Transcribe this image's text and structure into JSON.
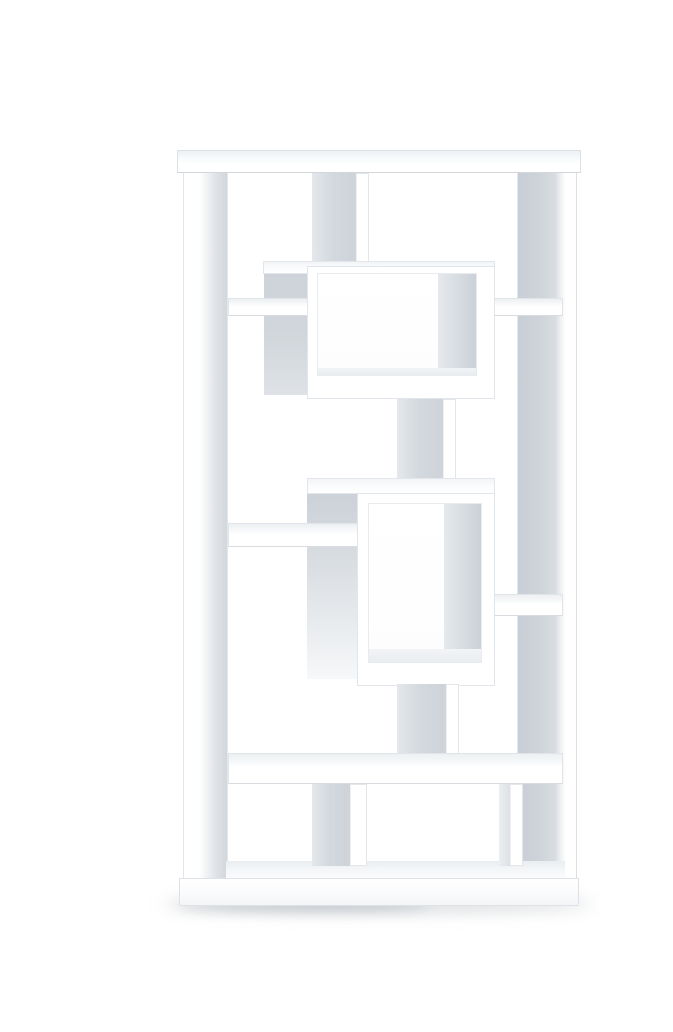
{
  "scene": {
    "type": "product-photo",
    "subject": "white geometric cube bookcase",
    "description": "Tall white geometric bookcase with asymmetric staggered open compartments and two protruding rectangular display cubes, photographed on a seamless white studio background with a soft floor shadow",
    "background_color": "#ffffff",
    "finish": "matte white"
  },
  "palette": {
    "surface_white": "#ffffff",
    "edge_line": "#e2e6ea",
    "side_face_gray": "#d0d6db",
    "side_face_gray_light": "#e6e9ed",
    "interior_wall_gray": "#cdd3d9",
    "floor_shadow": "#aab2ba"
  },
  "parts": [
    {
      "name": "top-cap",
      "kind": "panel"
    },
    {
      "name": "left-side-panel",
      "kind": "panel"
    },
    {
      "name": "right-side-panel",
      "kind": "panel"
    },
    {
      "name": "base-kickboard",
      "kind": "panel"
    },
    {
      "name": "floor-shelf",
      "kind": "shelf"
    },
    {
      "name": "top-divider",
      "kind": "divider"
    },
    {
      "name": "upper-left-shelf",
      "kind": "shelf"
    },
    {
      "name": "upper-right-shelf",
      "kind": "shelf"
    },
    {
      "name": "upper-display-cube",
      "kind": "protruding-cube"
    },
    {
      "name": "mid-upper-divider",
      "kind": "divider"
    },
    {
      "name": "mid-left-shelf",
      "kind": "shelf"
    },
    {
      "name": "mid-right-shelf",
      "kind": "shelf"
    },
    {
      "name": "middle-display-cube",
      "kind": "protruding-cube"
    },
    {
      "name": "mid-lower-divider",
      "kind": "divider"
    },
    {
      "name": "long-bottom-shelf",
      "kind": "shelf"
    },
    {
      "name": "bottom-left-divider",
      "kind": "divider"
    },
    {
      "name": "bottom-right-divider",
      "kind": "divider"
    },
    {
      "name": "floor-drop-shadow",
      "kind": "shadow"
    }
  ]
}
